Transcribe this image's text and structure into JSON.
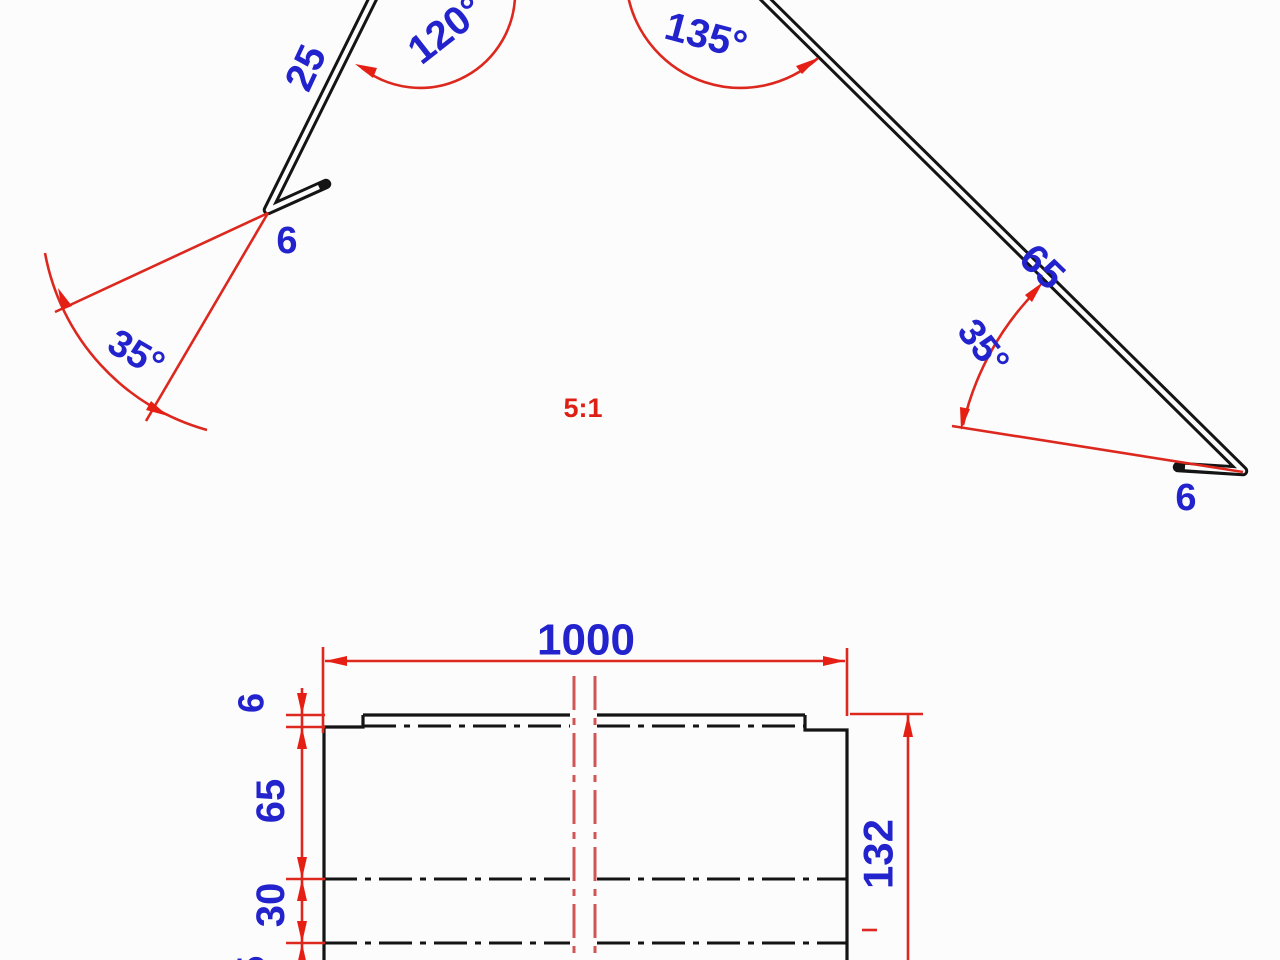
{
  "drawing": {
    "scale_label": "5:1",
    "profile_view": {
      "left_hem_length": "6",
      "left_leg_length": "25",
      "left_bend_angle": "120°",
      "right_bend_angle": "135°",
      "right_leg_length": "65",
      "right_hem_length": "6",
      "left_hem_angle": "35°",
      "right_hem_angle": "35°"
    },
    "flat_view": {
      "overall_width": "1000",
      "overall_girth": "132",
      "segment_hem_top": "6",
      "segment_leg": "65",
      "segment_middle": "30",
      "segment_bottom": "25"
    },
    "colors": {
      "dimension_text_blue": "#2323cd",
      "dimension_line_red": "#dc281e",
      "centerline_red": "#d05555",
      "outline_black": "#141414",
      "background": "#fcfcfc"
    }
  }
}
